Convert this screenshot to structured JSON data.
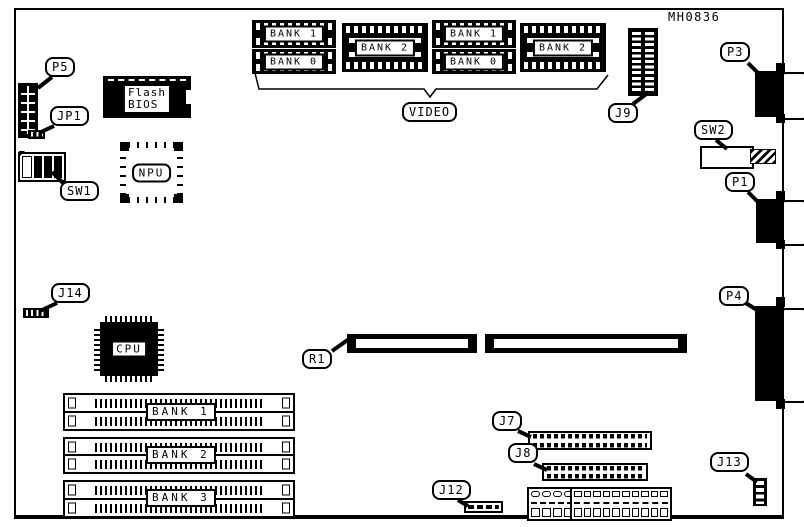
{
  "figure_code": "MH0836",
  "colors": {
    "ink": "#000000",
    "paper": "#ffffff"
  },
  "callouts": {
    "p5": "P5",
    "jp1": "JP1",
    "sw1": "SW1",
    "j14": "J14",
    "r1": "R1",
    "j9": "J9",
    "p3": "P3",
    "sw2": "SW2",
    "p1": "P1",
    "p4": "P4",
    "j7": "J7",
    "j8": "J8",
    "j12": "J12",
    "j13": "J13",
    "video": "VIDEO"
  },
  "chips": {
    "flash_line1": "Flash",
    "flash_line2": "BIOS",
    "npu": "NPU",
    "cpu": "CPU"
  },
  "video_memory": {
    "group_a": [
      "BANK 1",
      "BANK 0"
    ],
    "group_b": "BANK 2",
    "group_c": [
      "BANK 1",
      "BANK 0"
    ],
    "group_d": "BANK 2"
  },
  "system_memory": [
    "BANK 1",
    "BANK 2",
    "BANK 3"
  ]
}
